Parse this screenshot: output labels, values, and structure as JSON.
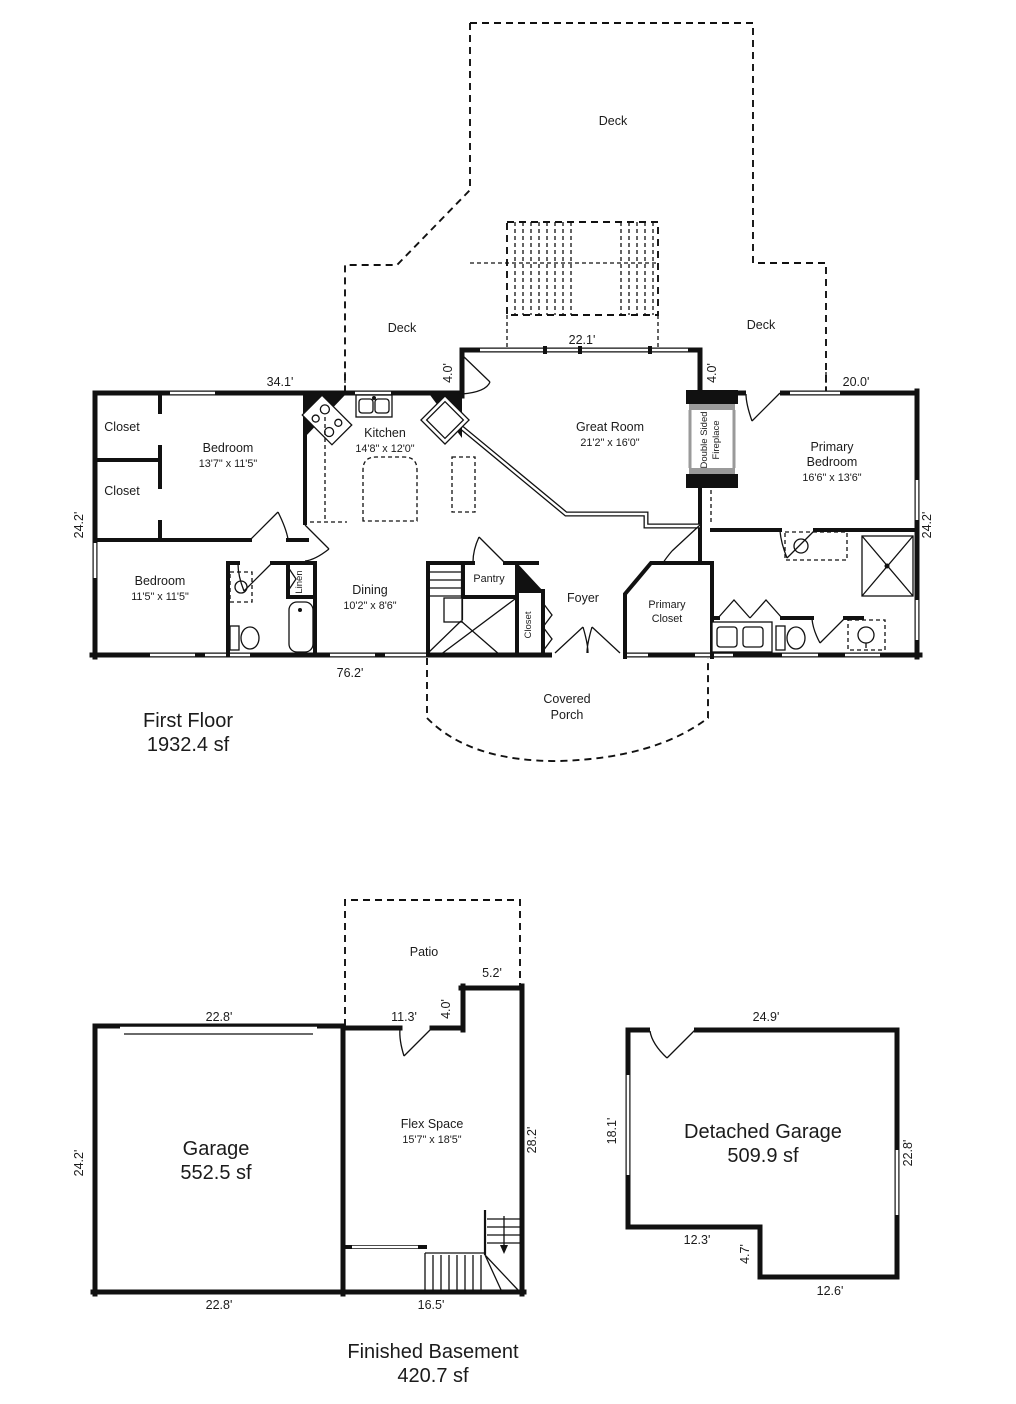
{
  "ff": {
    "title": "First Floor",
    "area": "1932.4 sf",
    "deck": "Deck",
    "dim_34_1": "34.1'",
    "dim_22_1": "22.1'",
    "dim_4_0": "4.0'",
    "dim_20_0": "20.0'",
    "dim_24_2": "24.2'",
    "dim_76_2": "76.2'",
    "closet": "Closet",
    "bedroom1": "Bedroom",
    "bedroom1_size": "13'7\" x 11'5\"",
    "kitchen": "Kitchen",
    "kitchen_size": "14'8\" x 12'0\"",
    "great": "Great Room",
    "great_size": "21'2\" x 16'0\"",
    "fire1": "Double Sided",
    "fire2": "Fireplace",
    "primary1": "Primary",
    "primary2": "Bedroom",
    "primary_size": "16'6\" x 13'6\"",
    "bedroom2": "Bedroom",
    "bedroom2_size": "11'5\" x 11'5\"",
    "linen": "Linen",
    "dining": "Dining",
    "dining_size": "10'2\" x 8'6\"",
    "pantry": "Pantry",
    "foyer": "Foyer",
    "pcloset1": "Primary",
    "pcloset2": "Closet",
    "porch1": "Covered",
    "porch2": "Porch"
  },
  "bm": {
    "title": "Finished Basement",
    "area": "420.7 sf",
    "patio": "Patio",
    "garage": "Garage",
    "garage_area": "552.5 sf",
    "flex": "Flex Space",
    "flex_size": "15'7\" x 18'5\"",
    "dim_22_8": "22.8'",
    "dim_11_3": "11.3'",
    "dim_4_0": "4.0'",
    "dim_5_2": "5.2'",
    "dim_24_2": "24.2'",
    "dim_28_2": "28.2'",
    "dim_16_5": "16.5'"
  },
  "dg": {
    "name": "Detached Garage",
    "area": "509.9 sf",
    "dim_24_9": "24.9'",
    "dim_18_1": "18.1'",
    "dim_22_8": "22.8'",
    "dim_12_3": "12.3'",
    "dim_4_7": "4.7'",
    "dim_12_6": "12.6'"
  }
}
